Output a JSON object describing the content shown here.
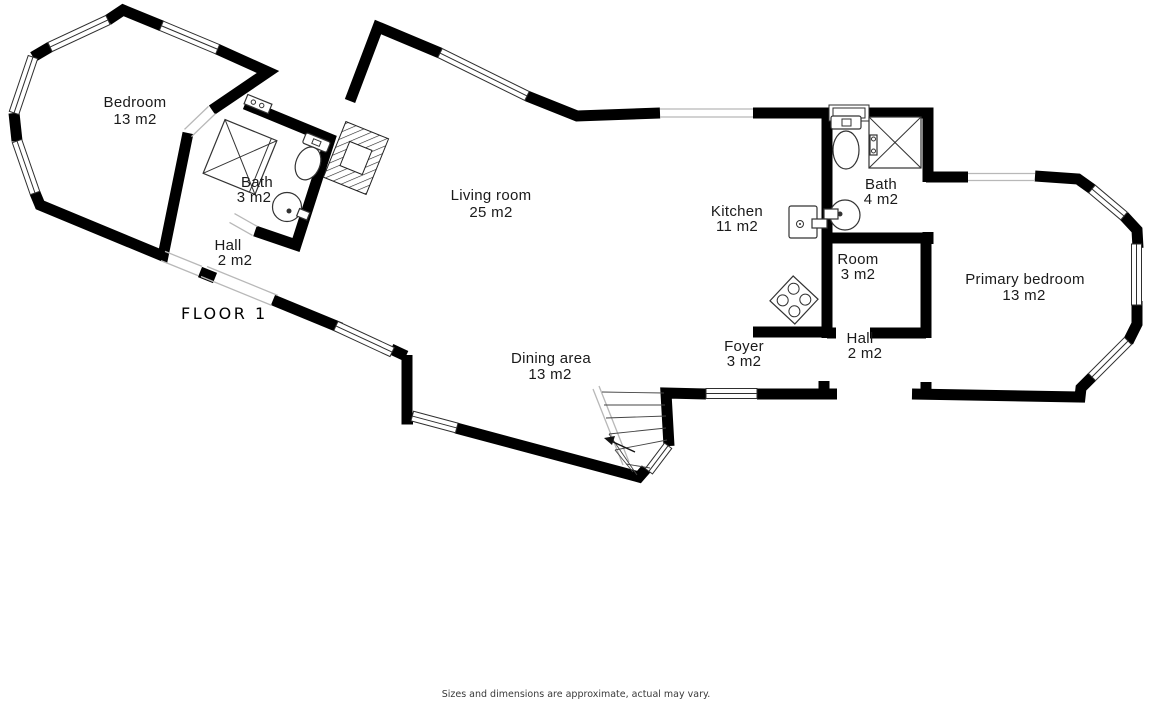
{
  "title": "FLOOR 1",
  "footer": "Sizes and dimensions are approximate, actual may vary.",
  "colors": {
    "wall": "#000000",
    "background": "#ffffff",
    "label": "#1a1a1a",
    "fixture_line": "#333333",
    "opening_line": "#b8b8b8"
  },
  "rooms": [
    {
      "id": "bedroom",
      "name": "Bedroom",
      "area": "13 m2"
    },
    {
      "id": "bath-small",
      "name": "Bath",
      "area": "3 m2"
    },
    {
      "id": "hall-left",
      "name": "Hall",
      "area": "2 m2"
    },
    {
      "id": "living-room",
      "name": "Living room",
      "area": "25 m2"
    },
    {
      "id": "dining-area",
      "name": "Dining area",
      "area": "13 m2"
    },
    {
      "id": "kitchen",
      "name": "Kitchen",
      "area": "11 m2"
    },
    {
      "id": "bath-main",
      "name": "Bath",
      "area": "4 m2"
    },
    {
      "id": "room-small",
      "name": "Room",
      "area": "3 m2"
    },
    {
      "id": "foyer",
      "name": "Foyer",
      "area": "3 m2"
    },
    {
      "id": "hall-right",
      "name": "Hall",
      "area": "2 m2"
    },
    {
      "id": "primary-bedroom",
      "name": "Primary bedroom",
      "area": "13 m2"
    }
  ],
  "fixtures": [
    "shower",
    "toilet",
    "sink",
    "stove",
    "stairs",
    "chimney",
    "window"
  ]
}
